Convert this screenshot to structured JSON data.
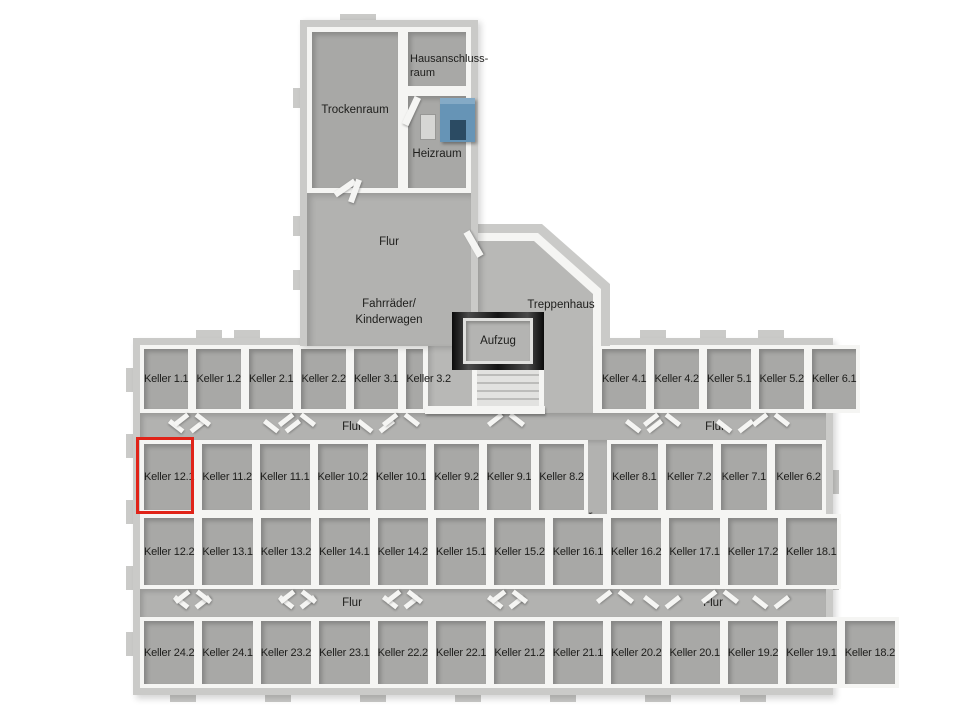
{
  "colors": {
    "background": "#ffffff",
    "outer_wall": "#cacac8",
    "wall": "#f5f5f3",
    "floor": "#a8a8a6",
    "corridor": "#b2b2b0",
    "stair_floor": "#b8b8b6",
    "boiler": "#6694b6",
    "elevator_frame": "#141414",
    "highlight": "#e02318",
    "text": "#1d1d1b"
  },
  "labels": {
    "flur": "Flur",
    "trockenraum": "Trockenraum",
    "hausanschluss_line1": "Hausanschluss-",
    "hausanschluss_line2": "raum",
    "heizraum": "Heizraum",
    "fahrraeder_line1": "Fahrräder/",
    "fahrraeder_line2": "Kinderwagen",
    "treppenhaus": "Treppenhaus",
    "aufzug": "Aufzug"
  },
  "cells": {
    "row1_left": [
      "Keller 1.1",
      "Keller 1.2",
      "Keller 2.1",
      "Keller 2.2",
      "Keller 3.1",
      "Keller 3.2"
    ],
    "row1_right": [
      "Keller 4.1",
      "Keller 4.2",
      "Keller 5.1",
      "Keller 5.2",
      "Keller 6.1"
    ],
    "row2_left": [
      "Keller 12.1",
      "Keller 11.2",
      "Keller 11.1",
      "Keller 10.2",
      "Keller 10.1",
      "Keller 9.2",
      "Keller 9.1",
      "Keller 8.2"
    ],
    "row2_right": [
      "Keller 8.1",
      "Keller 7.2",
      "Keller 7.1",
      "Keller 6.2"
    ],
    "row3_left": [
      "Keller 12.2",
      "Keller 13.1",
      "Keller 13.2",
      "Keller 14.1",
      "Keller 14.2",
      "Keller 15.1",
      "Keller 15.2",
      "Keller 16.1"
    ],
    "row3_right": [
      "Keller 16.2",
      "Keller 17.1",
      "Keller 17.2",
      "Keller 18.1"
    ],
    "row4": [
      "Keller 24.2",
      "Keller 24.1",
      "Keller 23.2",
      "Keller 23.1",
      "Keller 22.2",
      "Keller 22.1",
      "Keller 21.2",
      "Keller 21.1",
      "Keller 20.2",
      "Keller 20.1",
      "Keller 19.2",
      "Keller 19.1",
      "Keller 18.2"
    ]
  },
  "highlight": {
    "room_label": "Keller 12.1"
  }
}
